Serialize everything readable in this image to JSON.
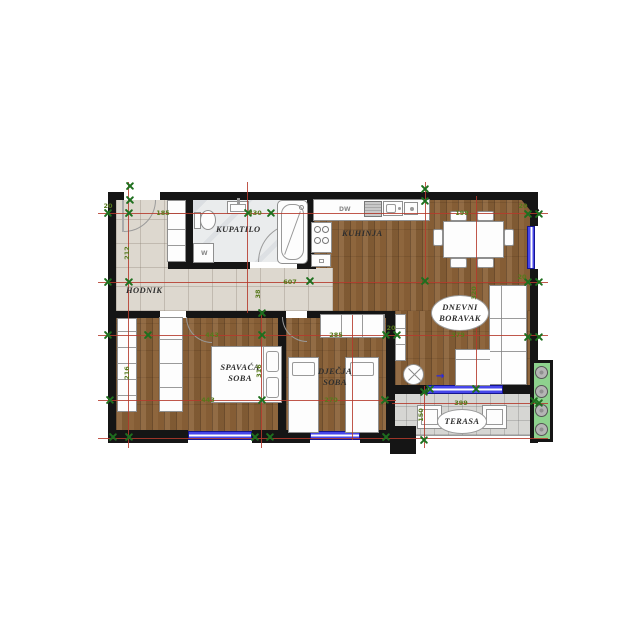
{
  "rooms": {
    "hodnik": "HODNIK",
    "kupatilo": "KUPATILO",
    "kuhinja": "KUHINJA",
    "dnevni1": "DNEVNI",
    "dnevni2": "BORAVAK",
    "spavaca1": "SPAVAĆA",
    "spavaca2": "SOBA",
    "djecja1": "DJEČJA",
    "djecja2": "SOBA",
    "terasa": "TERASA"
  },
  "appliances": {
    "dishwasher": "DW",
    "washing_machine": "W"
  },
  "dimensions": [
    {
      "text": "185",
      "x": 163,
      "y": 213,
      "rot": 0
    },
    {
      "text": "330",
      "x": 255,
      "y": 213,
      "rot": 0
    },
    {
      "text": "199",
      "x": 462,
      "y": 213,
      "rot": 0
    },
    {
      "text": "607",
      "x": 290,
      "y": 282,
      "rot": 0
    },
    {
      "text": "38",
      "x": 258,
      "y": 294,
      "rot": 1
    },
    {
      "text": "212",
      "x": 127,
      "y": 253,
      "rot": 1
    },
    {
      "text": "216",
      "x": 127,
      "y": 373,
      "rot": 1
    },
    {
      "text": "320",
      "x": 474,
      "y": 293,
      "rot": 1
    },
    {
      "text": "443",
      "x": 212,
      "y": 335,
      "rot": 0
    },
    {
      "text": "285",
      "x": 336,
      "y": 335,
      "rot": 0
    },
    {
      "text": "379",
      "x": 458,
      "y": 335,
      "rot": 0
    },
    {
      "text": "443",
      "x": 208,
      "y": 400,
      "rot": 0
    },
    {
      "text": "270",
      "x": 331,
      "y": 400,
      "rot": 0
    },
    {
      "text": "316",
      "x": 259,
      "y": 371,
      "rot": 1
    },
    {
      "text": "399",
      "x": 461,
      "y": 403,
      "rot": 0
    },
    {
      "text": "150",
      "x": 421,
      "y": 415,
      "rot": 1
    },
    {
      "text": "20",
      "x": 108,
      "y": 206,
      "rot": 0
    },
    {
      "text": "20",
      "x": 523,
      "y": 206,
      "rot": 0
    },
    {
      "text": "20",
      "x": 522,
      "y": 277,
      "rot": 0
    },
    {
      "text": "20",
      "x": 391,
      "y": 328,
      "rot": 0
    }
  ],
  "markers": [
    [
      130,
      186
    ],
    [
      130,
      200
    ],
    [
      108,
      213
    ],
    [
      129,
      213
    ],
    [
      248,
      213
    ],
    [
      271,
      213
    ],
    [
      425,
      189
    ],
    [
      425,
      201
    ],
    [
      528,
      214
    ],
    [
      539,
      214
    ],
    [
      108,
      282
    ],
    [
      129,
      282
    ],
    [
      310,
      281
    ],
    [
      425,
      281
    ],
    [
      528,
      282
    ],
    [
      539,
      282
    ],
    [
      262,
      313
    ],
    [
      108,
      335
    ],
    [
      148,
      335
    ],
    [
      262,
      335
    ],
    [
      386,
      335
    ],
    [
      397,
      335
    ],
    [
      528,
      337
    ],
    [
      539,
      337
    ],
    [
      110,
      400
    ],
    [
      262,
      400
    ],
    [
      385,
      400
    ],
    [
      430,
      389
    ],
    [
      476,
      389
    ],
    [
      424,
      392
    ],
    [
      534,
      401
    ],
    [
      539,
      403
    ],
    [
      424,
      440
    ],
    [
      113,
      437
    ],
    [
      129,
      437
    ],
    [
      255,
      437
    ],
    [
      270,
      437
    ],
    [
      386,
      437
    ]
  ],
  "colors": {
    "wall": "#151515",
    "dimension_red": "#b5392c",
    "marker_green": "#1e6f1e",
    "dim_text_green": "#57791c",
    "window_blue": "#4646ea",
    "wood": "#8a6137",
    "tile": "#ddd8cf",
    "marble": "#eaeced",
    "terrace_tile": "#d6d6d3",
    "planter_green": "#8ed28e"
  }
}
